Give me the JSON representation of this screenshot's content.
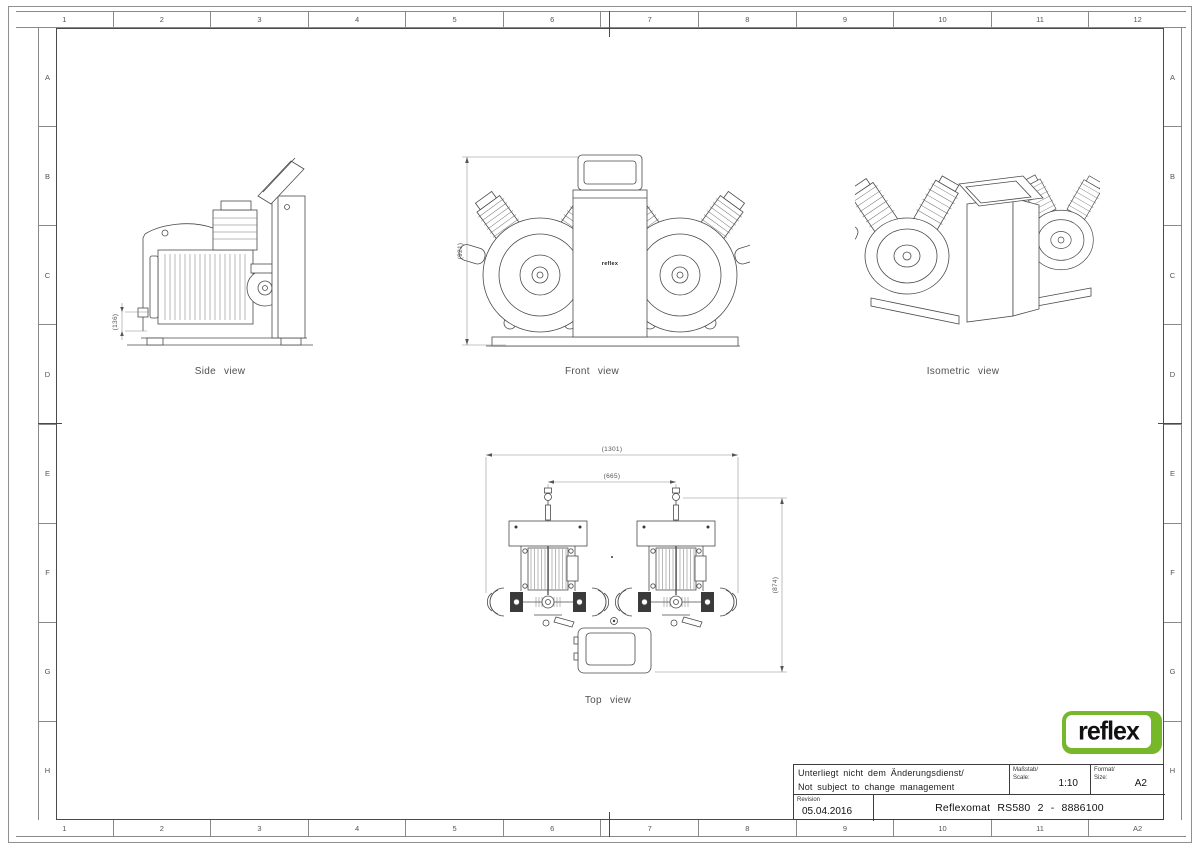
{
  "sheet": {
    "cols_top": [
      "1",
      "2",
      "3",
      "4",
      "5",
      "6",
      "7",
      "8",
      "9",
      "10",
      "11",
      "12"
    ],
    "cols_bottom": [
      "1",
      "2",
      "3",
      "4",
      "5",
      "6",
      "7",
      "8",
      "9",
      "10",
      "11",
      "A2"
    ],
    "rows": [
      "A",
      "B",
      "C",
      "D",
      "E",
      "F",
      "G",
      "H"
    ]
  },
  "views": {
    "side": {
      "caption": "Side view",
      "dim_height": "(136)"
    },
    "front": {
      "caption": "Front view",
      "dim_height": "(921)",
      "unit_label": "reflex"
    },
    "isometric": {
      "caption": "Isometric view"
    },
    "top": {
      "caption": "Top view",
      "dim_overall_width": "(1301)",
      "dim_center_distance": "(665)",
      "dim_depth": "(874)"
    }
  },
  "title_block": {
    "disclaimer_de": "Unterliegt nicht dem Änderungsdienst/",
    "disclaimer_en": "Not subject to change management",
    "scale_label_de": "Maßstab/",
    "scale_label_en": "Scale:",
    "scale_value": "1:10",
    "format_label_de": "Format/",
    "format_label_en": "Size:",
    "format_value": "A2",
    "revision_label": "Revision",
    "revision_date": "05.04.2016",
    "drawing_title": "Reflexomat RS580 2 - 8886100"
  },
  "logo": {
    "text": "reflex"
  }
}
